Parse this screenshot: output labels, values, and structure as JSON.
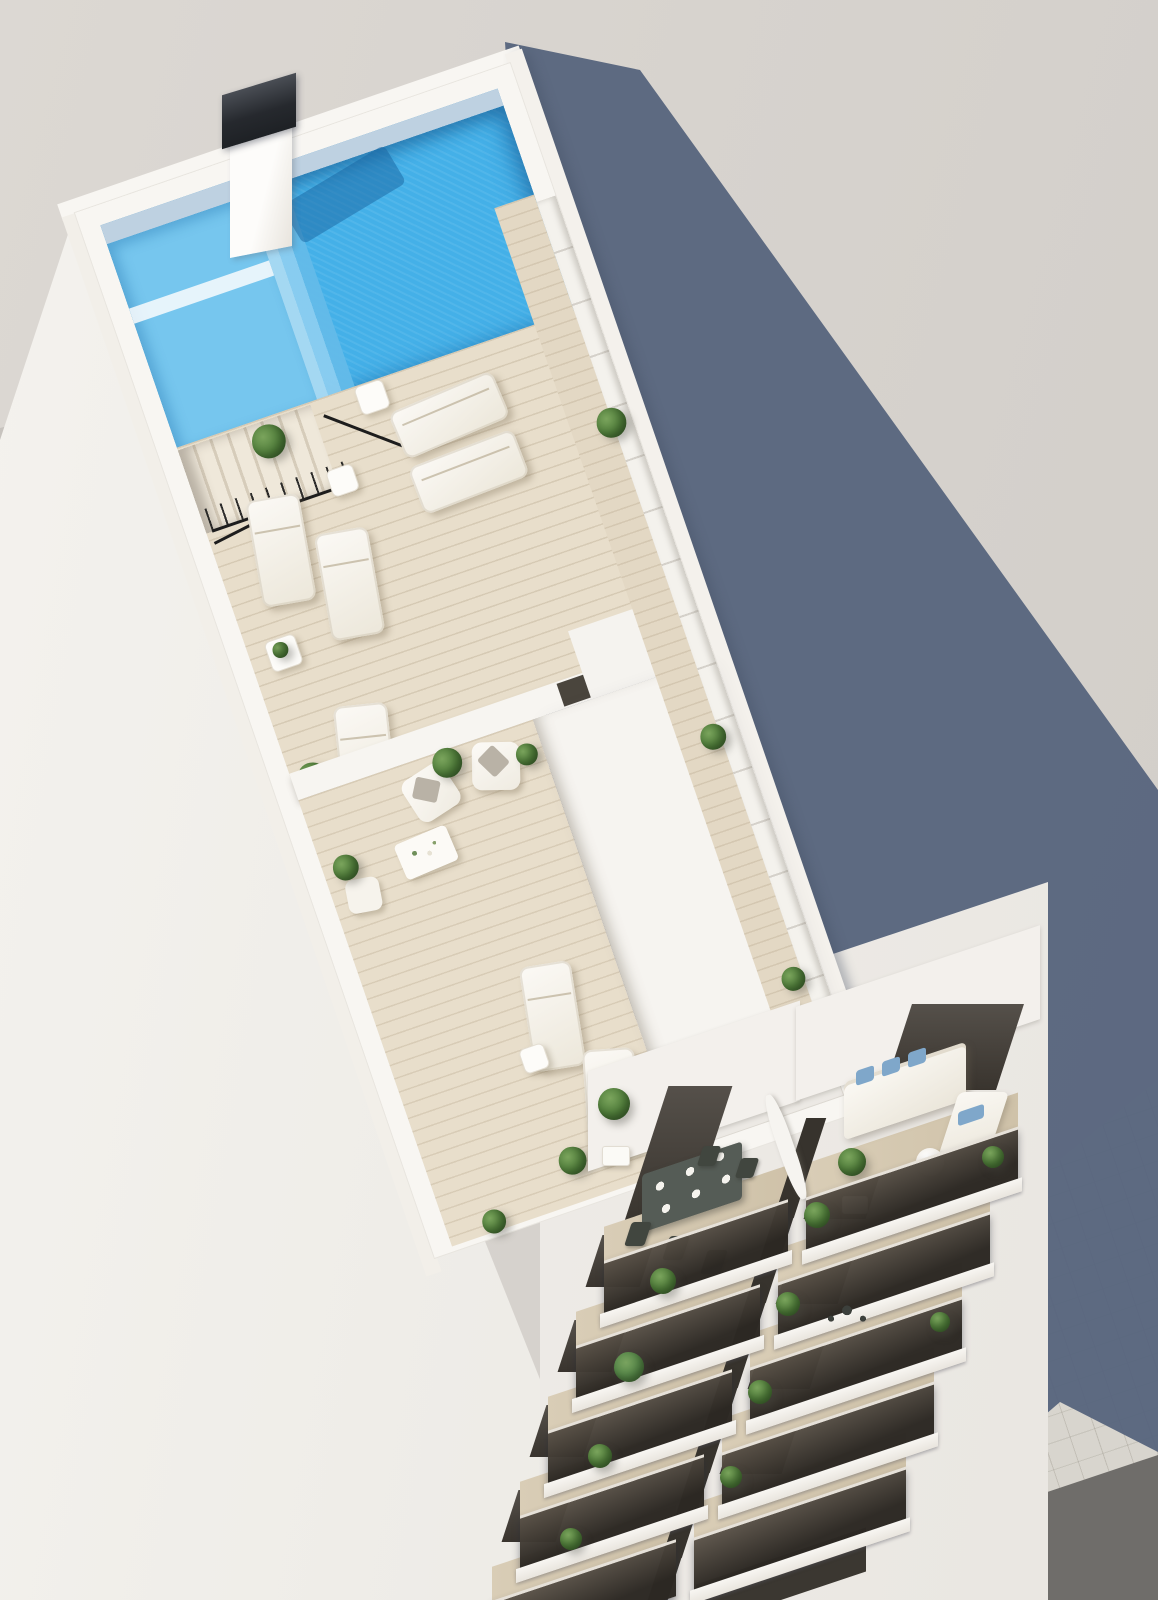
{
  "scene": {
    "type": "architectural-3d-render",
    "description": "Aerial axonometric render of a narrow white residential building with a bright blue rooftop pool, timber sun-deck terraces with loungers and plants, a lower penthouse lounge terrace, two columns of stacked balconies with outdoor furniture, a tiled sidewalk and asphalt road at street level, and a long slate-blue shadow cast to the right over neighbouring flat roofs.",
    "elements": [
      "rooftop-pool",
      "pool-shallow-steps",
      "chimney",
      "stair-railing",
      "sun-loungers",
      "privacy-screen",
      "roof-bulkhead",
      "penthouse-terrace",
      "lounge-armchairs",
      "coffee-table",
      "balcony-dining-table",
      "balcony-sofa-blue-cushions",
      "balcony-glass-balustrades",
      "planter-shrubs",
      "sidewalk",
      "road",
      "building-shadow",
      "neighbor-roof"
    ]
  },
  "colors": {
    "ground": "#d7d3ce",
    "ground_light": "#dcd8d3",
    "ground_dark": "#d2cec9",
    "neighbor_roof": "#c7c3be",
    "building_white": "#f4f2ee",
    "parapet_white": "#f8f6f2",
    "bulkhead_white": "#f6f4f0",
    "screen_white": "#f4f2ed",
    "pool_blue": "#44b0e8",
    "pool_light": "#76c6ee",
    "pool_deep": "#2f96d6",
    "deck_wood": "#e8decb",
    "plant_green": "#4f7c3a",
    "shadow_blue": "#55637c",
    "balcony_glass_dark": "#332f2a",
    "chimney_dark": "#26292e",
    "sidewalk": "#d8d5ce",
    "road": "#6f6d6a",
    "cushion_blue": "#7fa7ca"
  }
}
